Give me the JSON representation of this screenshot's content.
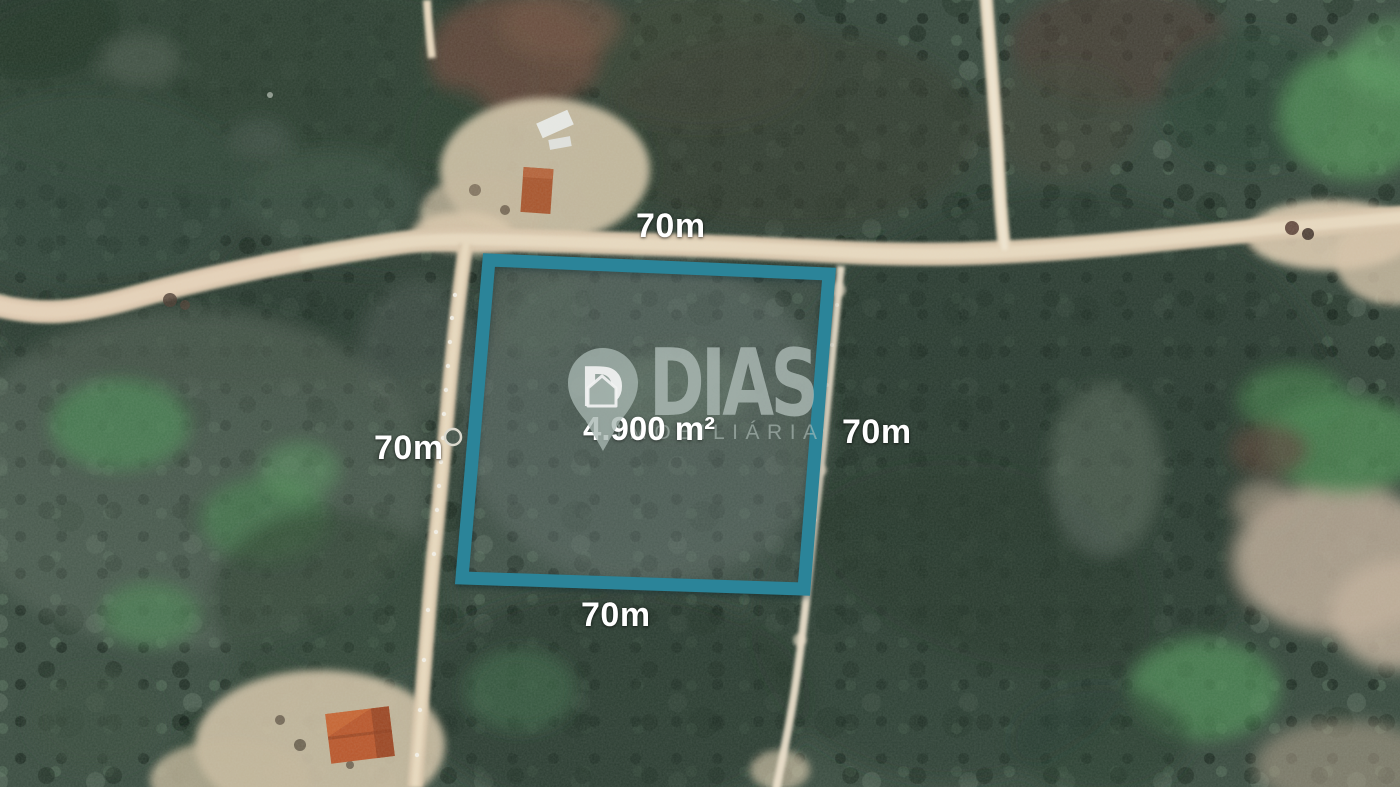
{
  "map": {
    "type": "satellite-photo-real-estate-listing",
    "plot": {
      "shape": "quadrilateral",
      "outline_color": "#2b8499",
      "side_labels": {
        "top": "70m",
        "left": "70m",
        "right": "70m",
        "bottom": "70m"
      },
      "area_label": "4.900 m²"
    },
    "watermark": {
      "brand": "DIAS",
      "tagline": "IMOBILIÁRIA",
      "pin_icon": "map-pin-house-icon",
      "color": "#aebcb7"
    },
    "label_color": "#ffffff"
  }
}
